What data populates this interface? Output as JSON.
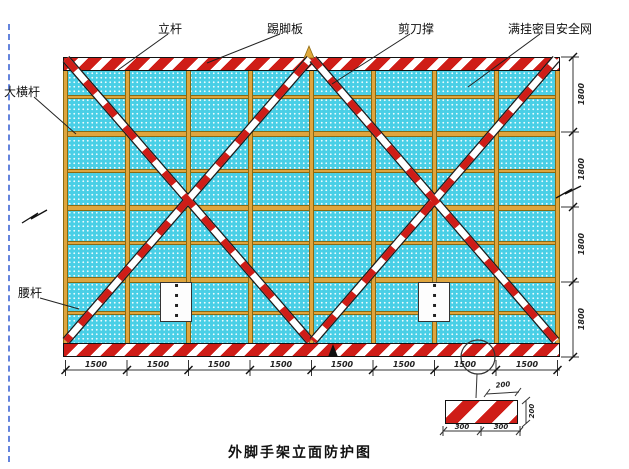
{
  "title": "外脚手架立面防护图",
  "callouts": {
    "top": {
      "pole": "立杆",
      "toe_board": "踢脚板",
      "scissor_brace": "剪刀撑",
      "safety_net": "满挂密目安全网"
    },
    "left": {
      "main_ledger": "大横杆",
      "waist_rail": "腰杆"
    }
  },
  "dimensions": {
    "bottom": [
      "1500",
      "1500",
      "1500",
      "1500",
      "1500",
      "1500",
      "1500",
      "1500"
    ],
    "right": [
      "1800",
      "1800",
      "1800",
      "1800"
    ],
    "detail_top": "200",
    "detail_side": "200",
    "detail_bottom": [
      "300",
      "300"
    ]
  },
  "structure": {
    "bays": 8,
    "rows": 8,
    "poles": 9,
    "horizontal_bars": 7
  },
  "placard_glyphs": "▪▪▪▪",
  "colors": {
    "mesh": "#49CFE6",
    "frame_yellow": "#DFA53D",
    "stripe_red": "#CF1D17",
    "dashed_edge_blue": "#4A6FD8"
  }
}
